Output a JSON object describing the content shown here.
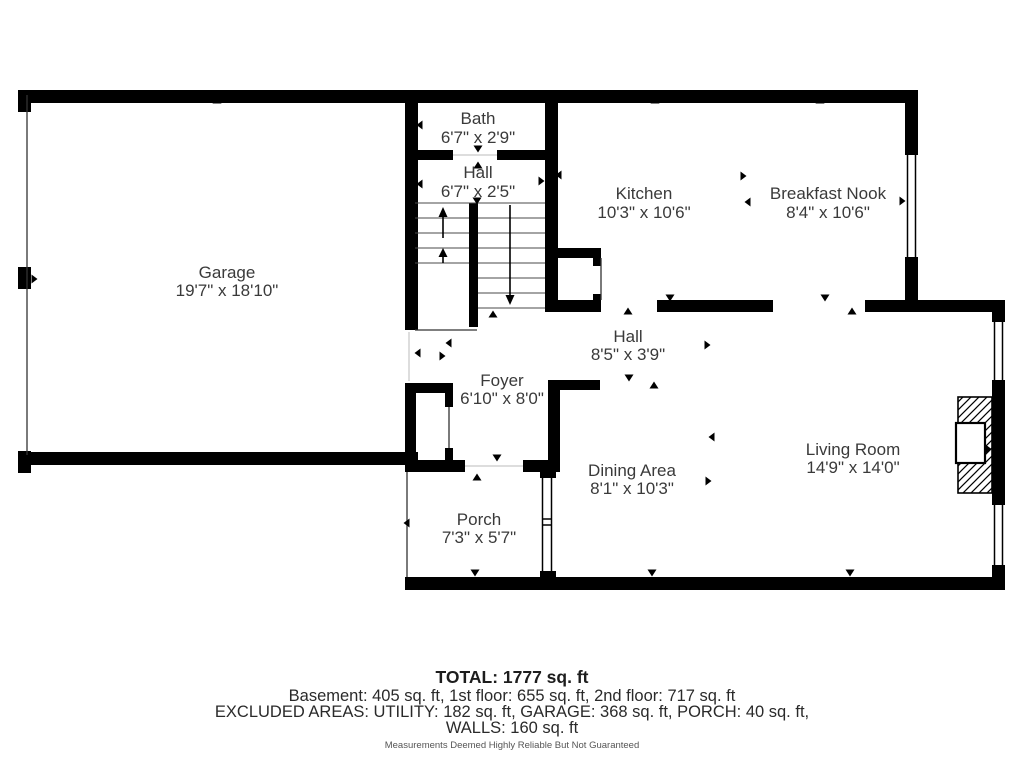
{
  "rooms": {
    "garage": {
      "name": "Garage",
      "dims": "19'7\" x 18'10\""
    },
    "bath": {
      "name": "Bath",
      "dims": "6'7\" x 2'9\""
    },
    "hall_upper": {
      "name": "Hall",
      "dims": "6'7\" x 2'5\""
    },
    "kitchen": {
      "name": "Kitchen",
      "dims": "10'3\" x 10'6\""
    },
    "breakfast_nook": {
      "name": "Breakfast Nook",
      "dims": "8'4\" x 10'6\""
    },
    "hall_main": {
      "name": "Hall",
      "dims": "8'5\" x 3'9\""
    },
    "foyer": {
      "name": "Foyer",
      "dims": "6'10\" x 8'0\""
    },
    "dining": {
      "name": "Dining Area",
      "dims": "8'1\" x 10'3\""
    },
    "living": {
      "name": "Living Room",
      "dims": "14'9\" x 14'0\""
    },
    "porch": {
      "name": "Porch",
      "dims": "7'3\" x 5'7\""
    }
  },
  "summary": {
    "total": "TOTAL: 1777 sq. ft",
    "floors": "Basement: 405 sq. ft, 1st floor: 655 sq. ft, 2nd floor: 717 sq. ft",
    "excluded": "EXCLUDED AREAS: UTILITY: 182 sq. ft, GARAGE: 368 sq. ft, PORCH: 40 sq. ft,",
    "walls": "WALLS: 160 sq. ft",
    "disclaimer": "Measurements Deemed Highly Reliable But Not Guaranteed"
  },
  "colors": {
    "wall": "#000000",
    "label_text": "#3a3a3a",
    "summary_text": "#2a2a2a",
    "disclaimer_text": "#555555",
    "background": "#ffffff"
  }
}
